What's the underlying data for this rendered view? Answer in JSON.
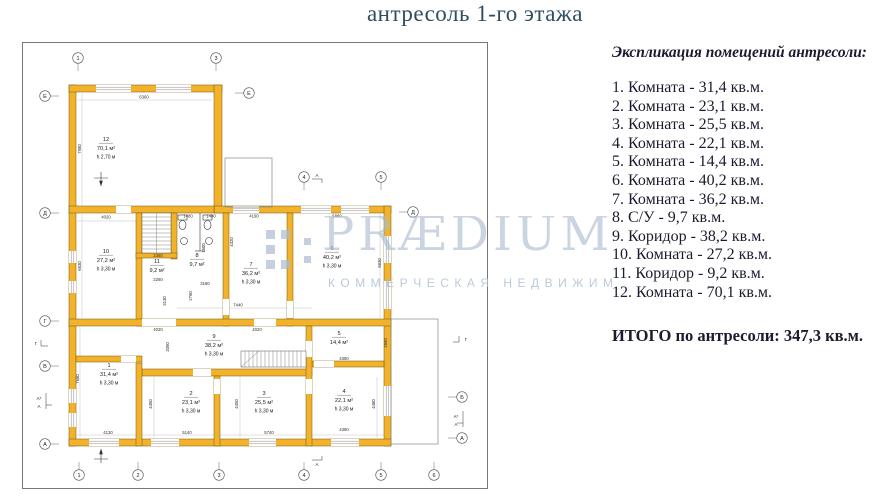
{
  "title": "антресоль 1-го этажа",
  "legend": {
    "header": "Экспликация помещений антресоли:",
    "items": [
      "1. Комната - 31,4 кв.м.",
      "2. Комната - 23,1 кв.м.",
      "3. Комната - 25,5 кв.м.",
      "4. Комната - 22,1 кв.м.",
      "5. Комната - 14,4 кв.м.",
      "6. Комната - 40,2 кв.м.",
      "7. Комната - 36,2 кв.м.",
      "8. С/У - 9,7 кв.м.",
      "9. Коридор - 38,2 кв.м.",
      "10. Комната - 27,2 кв.м.",
      "11. Коридор - 9,2 кв.м.",
      "12. Комната - 70,1 кв.м."
    ],
    "total": "ИТОГО по антресоли: 347,3 кв.м."
  },
  "watermark": {
    "brand": "PRÆDIUM",
    "tagline": "КОММЕРЧЕСКАЯ НЕДВИЖИМ",
    "color": "#abbcce"
  },
  "plan": {
    "wall_color": "#F2B32B",
    "rooms": [
      {
        "num": "12",
        "area": "70,1 м²",
        "height": "h 2,70 м"
      },
      {
        "num": "10",
        "area": "27,2 м²",
        "height": "h 3,30 м"
      },
      {
        "num": "11",
        "area": "9,2 м²",
        "height": ""
      },
      {
        "num": "8",
        "area": "9,7 м²",
        "height": ""
      },
      {
        "num": "7",
        "area": "36,2 м²",
        "height": "h 3,30 м"
      },
      {
        "num": "6",
        "area": "40,2 м²",
        "height": "h 3,30 м"
      },
      {
        "num": "9",
        "area": "38,2 м²",
        "height": "h 3,30 м"
      },
      {
        "num": "1",
        "area": "31,4 м²",
        "height": "h 3,30 м"
      },
      {
        "num": "2",
        "area": "23,1 м²",
        "height": "h 3,30 м"
      },
      {
        "num": "3",
        "area": "25,5 м²",
        "height": "h 3,30 м"
      },
      {
        "num": "5",
        "area": "14,4 м²",
        "height": ""
      },
      {
        "num": "4",
        "area": "22,1 м²",
        "height": "h 3,30 м"
      }
    ],
    "dims": [
      "6360",
      "7980",
      "4020",
      "1480",
      "1480",
      "4190",
      "5880",
      "6630",
      "6830",
      "4320",
      "1500",
      "2360",
      "2260",
      "3180",
      "2760",
      "3130",
      "7440",
      "4020",
      "4020",
      "2090",
      "7680",
      "4450",
      "4450",
      "4480",
      "2690",
      "4380",
      "4380",
      "4130",
      "5140",
      "5740"
    ],
    "axes": {
      "top": [
        "1",
        "3",
        "4",
        "5"
      ],
      "bottom": [
        "1",
        "2",
        "3",
        "4",
        "5",
        "6"
      ],
      "left": [
        "Е",
        "Д",
        "Г",
        "В",
        "А"
      ],
      "right": [
        "Е",
        "Д",
        "Б",
        "А"
      ]
    },
    "markers": {
      "g": "Г",
      "a_star": "А*",
      "a": "А"
    }
  }
}
